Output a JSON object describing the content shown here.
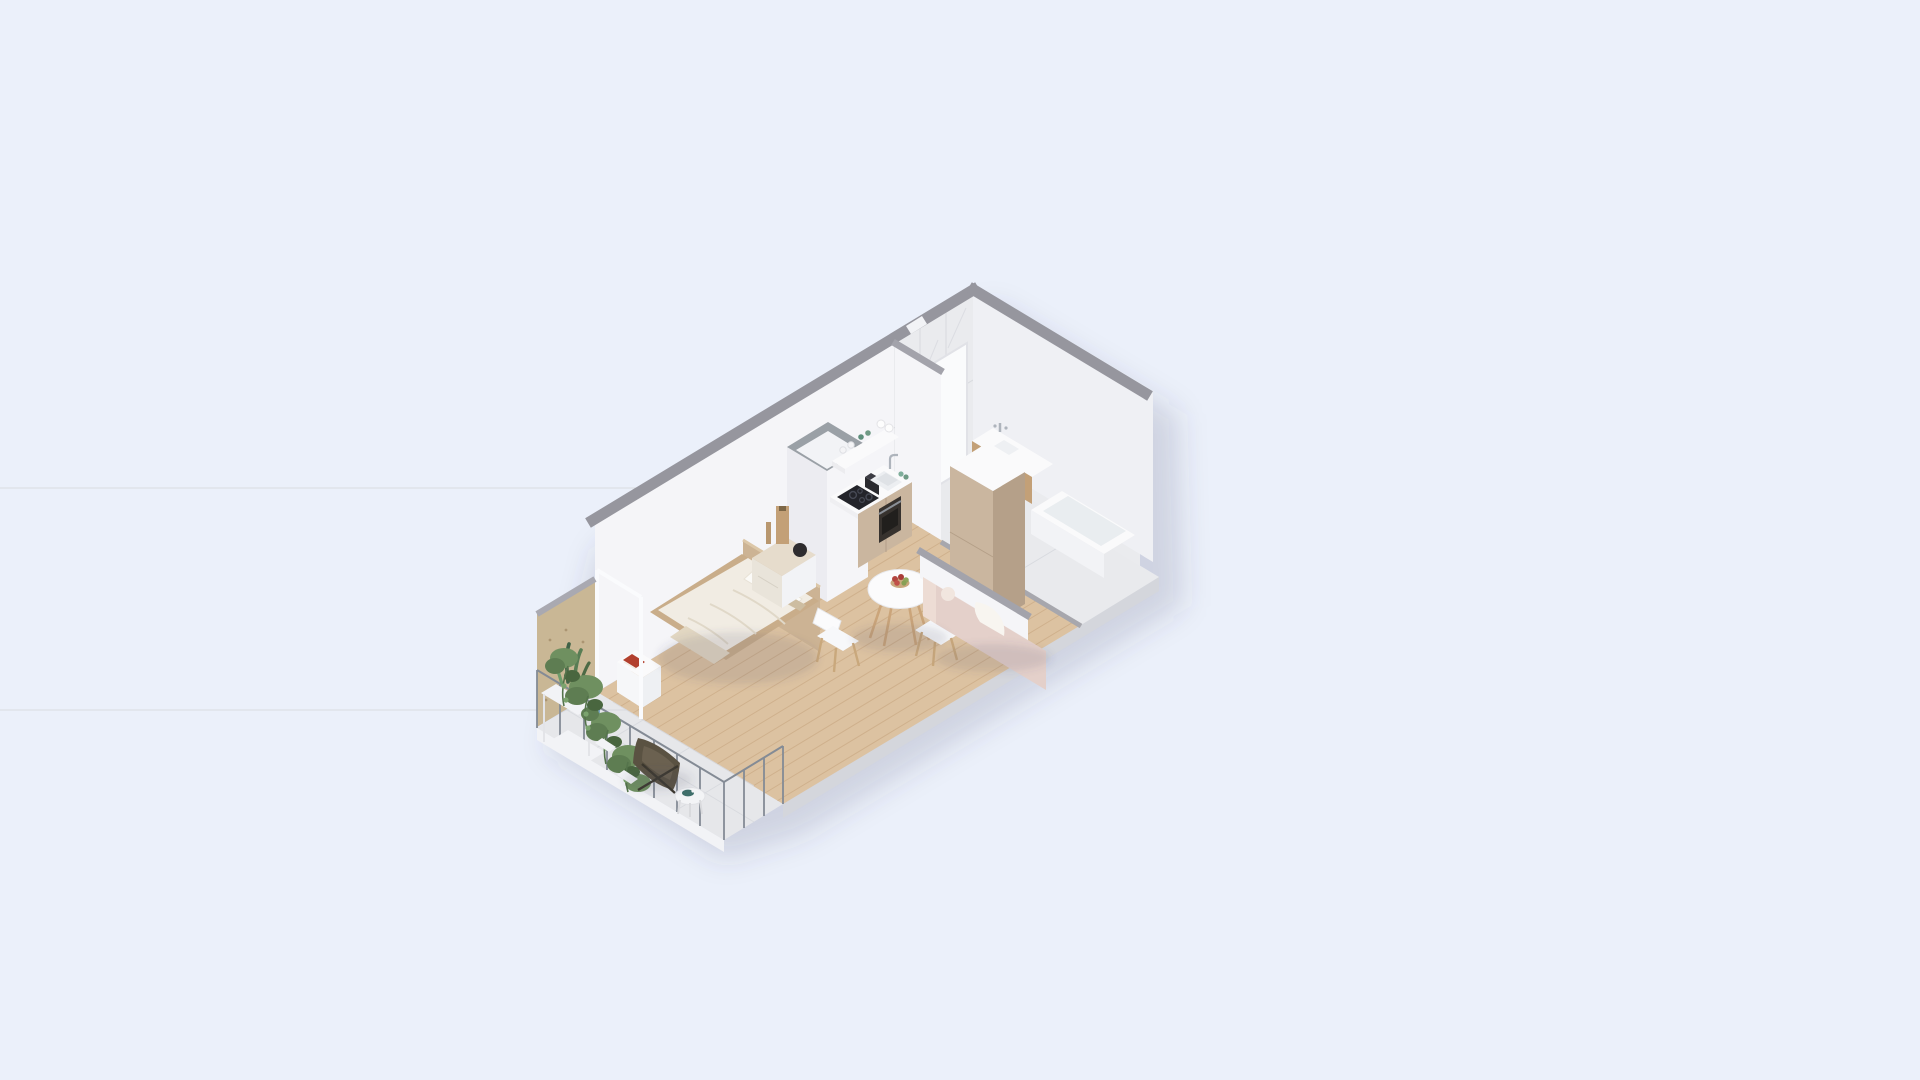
{
  "image_type": "isometric 3D floor plan render",
  "scene": {
    "description": "Cutaway isometric render of a small studio apartment with balcony",
    "background_color": "#ebf0fa",
    "shadow_color": "rgba(60,70,100,0.18)"
  },
  "palette": {
    "background": "#ebf0fa",
    "wall_top_gray": "#96969e",
    "wall_white": "#f5f5f8",
    "marble": "#eaebee",
    "wood_floor": "#dcc2a1",
    "cabinet_beige": "#cab69f",
    "cabinet_beige_shade": "#b5a089",
    "plywood": "#c9b795",
    "sofa_pink": "#e4d0ca",
    "plant_green": "#5e7d52",
    "appliance_black": "#23242a",
    "accent_blue_pot": "#7aa6c4",
    "accent_red_book": "#b2402e"
  },
  "rooms": [
    {
      "name": "bathroom",
      "position": "top-right end",
      "features": [
        "marble walls",
        "marble floor",
        "floating vanity with basin and faucet",
        "bathtub",
        "white door"
      ]
    },
    {
      "name": "kitchen",
      "position": "center-right along back wall",
      "features": [
        "white countertop",
        "induction cooktop",
        "oven",
        "toaster",
        "sink with faucet",
        "open shelf with glasses and cups",
        "tall fridge column",
        "services shaft"
      ]
    },
    {
      "name": "living-dining",
      "position": "center-front",
      "features": [
        "round dining table",
        "fruit bowl with apples",
        "two white chairs",
        "pink sofa with white throw",
        "low hallway wall"
      ]
    },
    {
      "name": "bedroom",
      "position": "left-center",
      "features": [
        "double bed with wood headboard",
        "pillows",
        "nightstand with red book",
        "wood dresser with vases"
      ]
    },
    {
      "name": "balcony",
      "position": "bottom-left end",
      "features": [
        "plywood privacy panel",
        "metal railing",
        "plant stand with trailing plants",
        "snake plant",
        "blue pot",
        "butterfly chair",
        "side table with teal tray",
        "tile floor"
      ]
    }
  ],
  "furniture_inventory": [
    "bed",
    "headboard",
    "nightstand",
    "dresser",
    "vases",
    "kitchen counter",
    "cooktop",
    "oven",
    "toaster",
    "sink",
    "open shelf",
    "fridge column",
    "dining table",
    "chairs",
    "fruit bowl",
    "sofa",
    "vanity",
    "bathtub",
    "door",
    "plywood panel",
    "plant stand",
    "plants",
    "butterfly chair",
    "side table",
    "railing"
  ]
}
